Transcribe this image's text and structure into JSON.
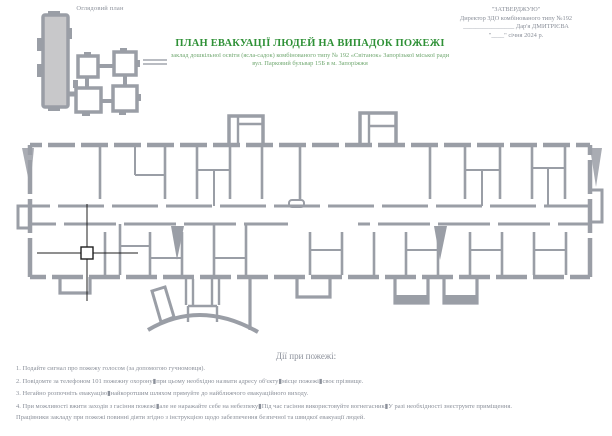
{
  "header": {
    "overview_label": "Оглядовий план",
    "title": "ПЛАН ЕВАКУАЦІЇ ЛЮДЕЙ НА ВИПАДОК ПОЖЕЖІ",
    "subtitle_line1": "заклад дошкільної освіти (ясла-садок) комбінованого типу № 192 «Світанок» Запорізької міської ради",
    "subtitle_line2": "вул. Парковий бульвар 15Б  в м. Запоріжжя",
    "approval": {
      "line1": "\"ЗАТВЕРДЖУЮ\"",
      "line2": "Директор ЗДО комбінованого типу №192",
      "line3": "________________ Дар'я ДМИТРІЄВА",
      "line4": "\"____\" січня 2024 р."
    }
  },
  "actions": {
    "title": "Дії при пожежі:",
    "items": [
      "1. Подайте сигнал про пожежу голосом (за допомогою гучномовця).",
      "2. Повідомте за телефоном 101 пожежну охорону▮при цьому необхідно назвати адресу об'єкту▮місце пожежі▮своє прізвище.",
      "3. Негайно розпочніть евакуацію▮найкоротшим шляхом прямуйте до найближчого евакуаційного виходу.",
      "4. При можливості вжити заходів з гасіння пожежі▮але не наражайте себе на небезпеку▮Під час гасіння використовуйте вогнегасник▮У разі необхідності знеструмте приміщення.",
      "Працівники закладу при пожежі повинні діяти згідно з інструкцією щодо забезпечення безпечної та швидкої евакуації людей."
    ]
  },
  "colors": {
    "title_green": "#2f9137",
    "subtitle_green": "#71a871",
    "text_gray": "#8b909a",
    "plan_gray": "#9a9ea6",
    "minimap_fill": "#c8c8ca",
    "cursor_black": "#1f1f1f"
  }
}
